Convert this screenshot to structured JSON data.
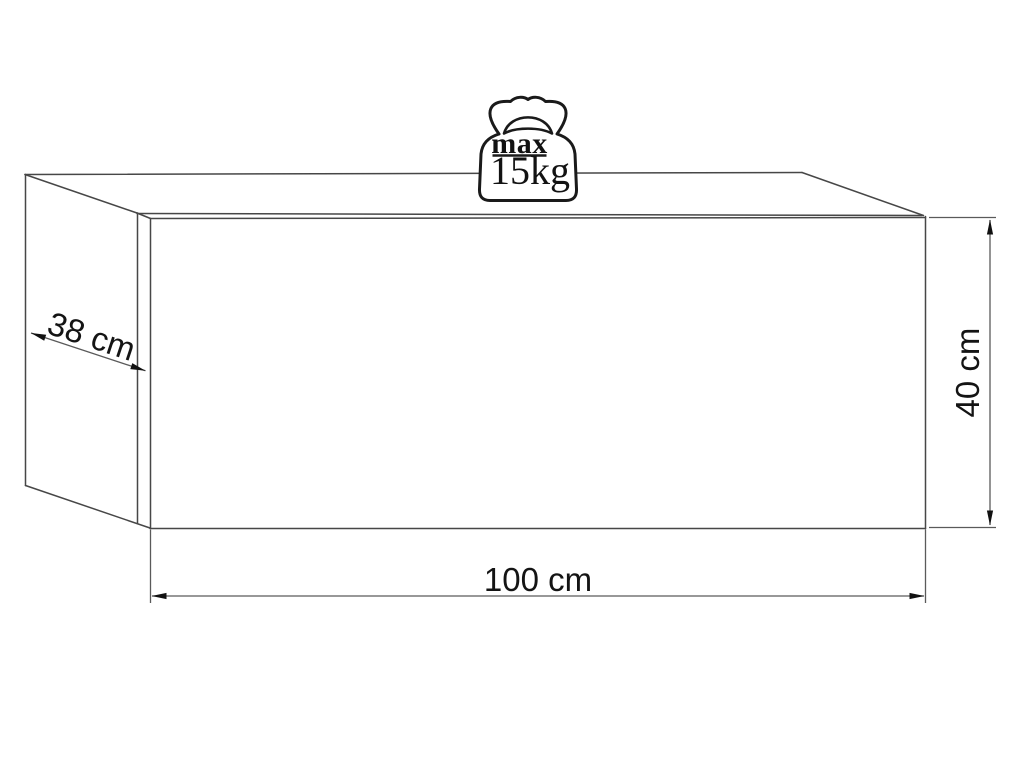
{
  "diagram": {
    "dimensions": {
      "depth": "38 cm",
      "width": "100 cm",
      "height": "40 cm"
    },
    "max_load": {
      "prefix": "max",
      "value": "15kg"
    },
    "colors": {
      "background": "#ffffff",
      "outline": "#474747",
      "dimension_line": "#5a5a5a",
      "arrow": "#111111",
      "text": "#141414",
      "icon": "#1a1a1a"
    },
    "icons": [
      "weight-icon"
    ]
  }
}
